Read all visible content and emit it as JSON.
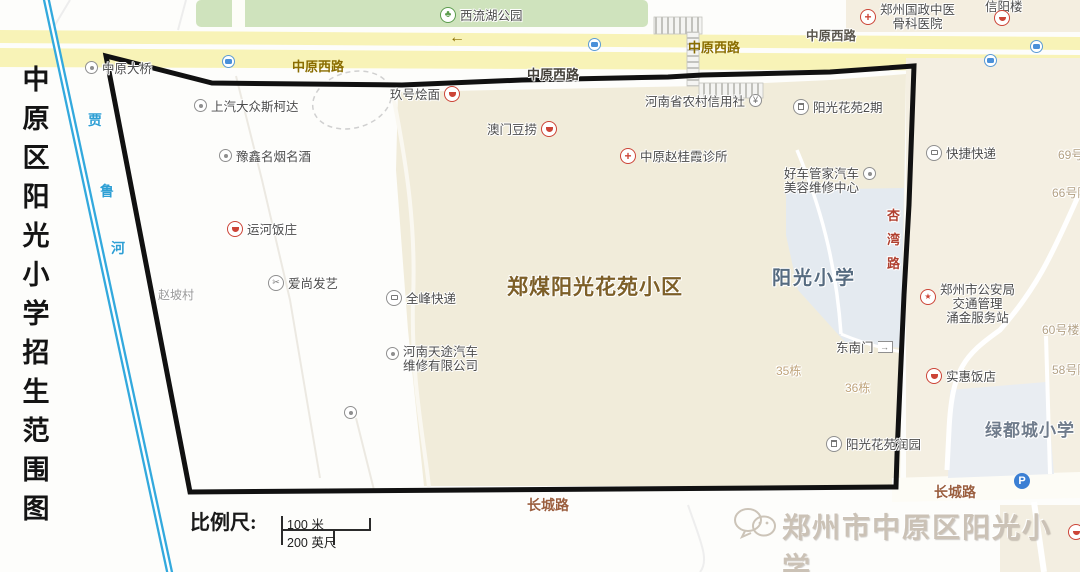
{
  "sidebar_title": {
    "text": "中原区阳光小学招生范围图",
    "chars": [
      "中",
      "原",
      "区",
      "阳",
      "光",
      "小",
      "学",
      "招",
      "生",
      "范",
      "围",
      "图"
    ]
  },
  "river": {
    "name": "贾鲁河",
    "chars": [
      "贾",
      "鲁",
      "河"
    ],
    "color": "#35aade"
  },
  "park": {
    "label": "西流湖公园"
  },
  "roads": {
    "zhongyuan_west": "中原西路",
    "changcheng": "长城路",
    "xingwan": "杏湾路",
    "xingwan_chars": [
      "杏",
      "湾",
      "路"
    ],
    "arrow": "←"
  },
  "areas": {
    "community": "郑煤阳光花苑小区",
    "school": "阳光小学",
    "school_green": "绿都城小学",
    "village": "赵坡村"
  },
  "buildings": {
    "b35": "35栋",
    "b36": "36栋",
    "b58": "58号院",
    "b60": "60号楼",
    "b66": "66号院",
    "b69": "69号"
  },
  "pois": {
    "bridge": "中原大桥",
    "skoda": "上汽大众斯柯达",
    "jiuhao": "玖号烩面",
    "aomen": "澳门豆捞",
    "rcu": "河南省农村信用社",
    "hospital_l1": "郑州国政中医",
    "hospital_l2": "骨科医院",
    "xinyang": "信阳楼",
    "yg2": "阳光花苑2期",
    "kuaijie": "快捷快递",
    "yuxin": "豫鑫名烟名酒",
    "clinic": "中原赵桂霞诊所",
    "haoche_l1": "好车管家汽车",
    "haoche_l2": "美容维修中心",
    "yunhe": "运河饭庄",
    "aishang": "爱尚发艺",
    "quanfeng": "全峰快递",
    "tiantu_l1": "河南天途汽车",
    "tiantu_l2": "维修有限公司",
    "police_l1": "郑州市公安局",
    "police_l2": "交通管理",
    "police_l3": "涌金服务站",
    "gate": "东南门",
    "shihui": "实惠饭店",
    "runyuan": "阳光花苑润园"
  },
  "scale": {
    "label": "比例尺:",
    "meters": "100 米",
    "feet": "200 英尺"
  },
  "watermark": {
    "text": "郑州市中原区阳光小学"
  },
  "icons": {
    "parking_icon": "P",
    "star_icon": "★",
    "cross_icon": "+",
    "park_icon": "♣",
    "yuan_icon": "¥",
    "scissors_icon": "✂"
  },
  "colors": {
    "boundary": "#111111",
    "river": "#35aade",
    "road_fill": "#f8f3b7",
    "park_fill": "#cfe3bd",
    "community_fill": "#f1ecda",
    "school_fill": "#e4eaf0",
    "accent_red": "#cc4437",
    "community_text": "#7d5f28",
    "school_text": "#566b80",
    "road_label_olive": "#8a6d00",
    "changcheng_text": "#9b5f3f"
  }
}
